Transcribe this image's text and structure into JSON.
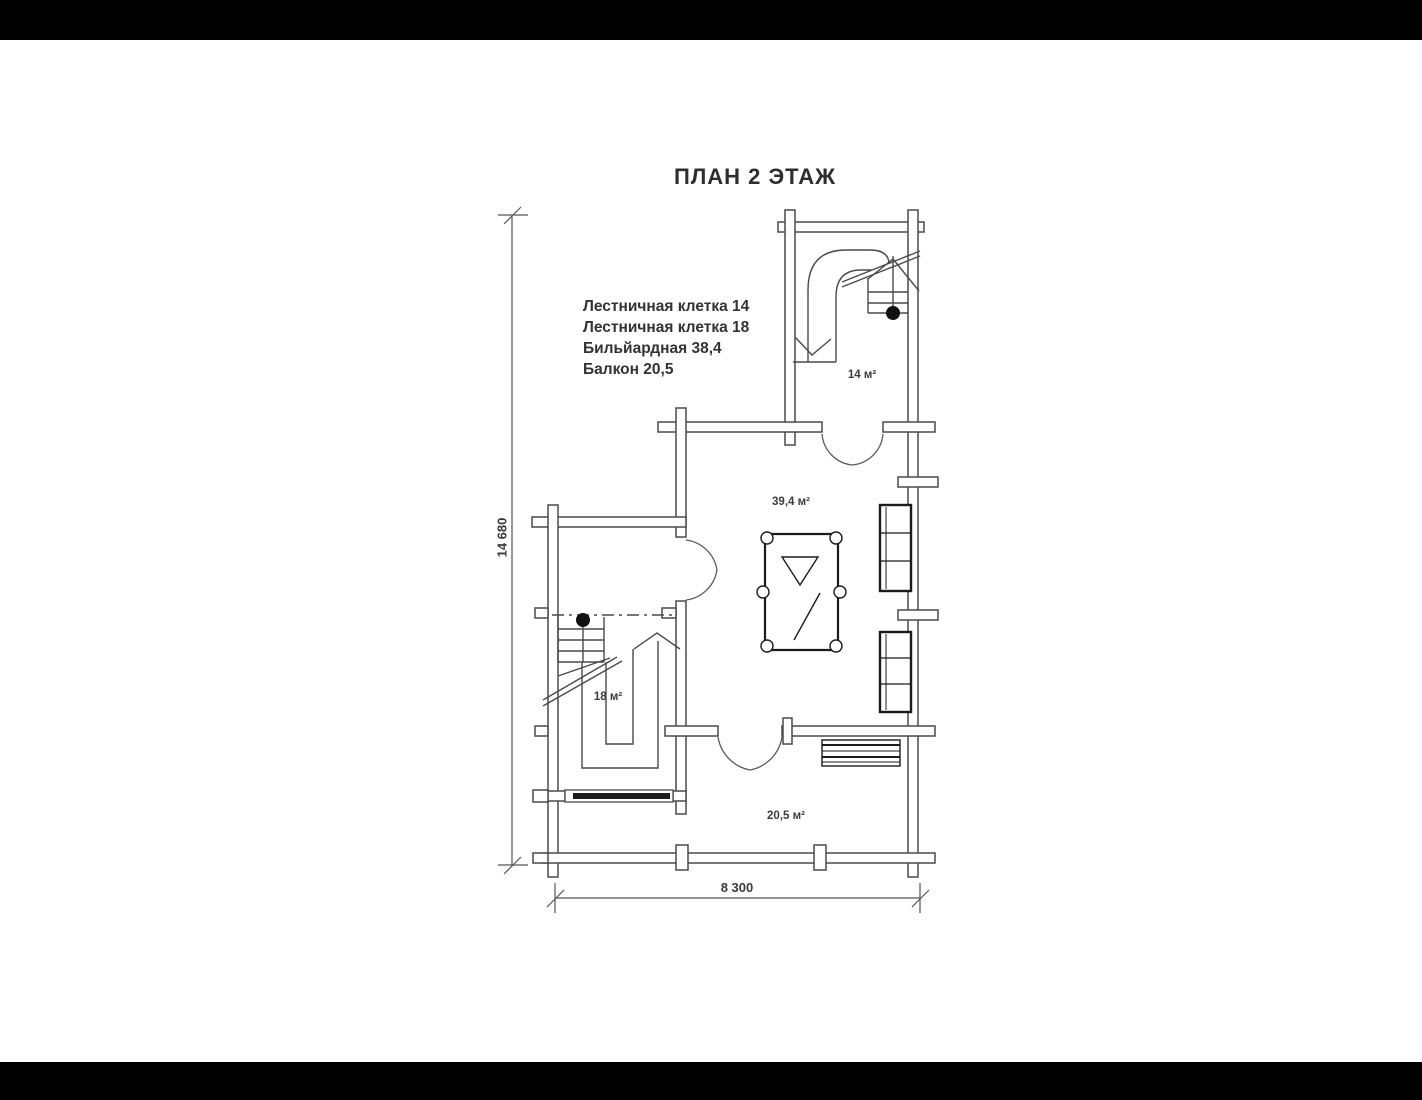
{
  "title": "ПЛАН 2 ЭТАЖ",
  "legend": {
    "items": [
      "Лестничная клетка 14",
      "Лестничная клетка 18",
      "Бильйардная 38,4",
      "Балкон 20,5"
    ]
  },
  "rooms": {
    "stair14_area": "14 м²",
    "billiard_area": "39,4 м²",
    "stair18_area": "18 м²",
    "balcony_area": "20,5 м²"
  },
  "dimensions": {
    "overall_height_mm": "14 680",
    "overall_width_mm": "8 300"
  },
  "colors": {
    "wall_line": "#4a4a4a",
    "furniture_line": "#1b1b1b",
    "dimension_line": "#555555",
    "window_bar": "#1c1c1c",
    "letterbox": "#000000",
    "paper": "#ffffff"
  }
}
